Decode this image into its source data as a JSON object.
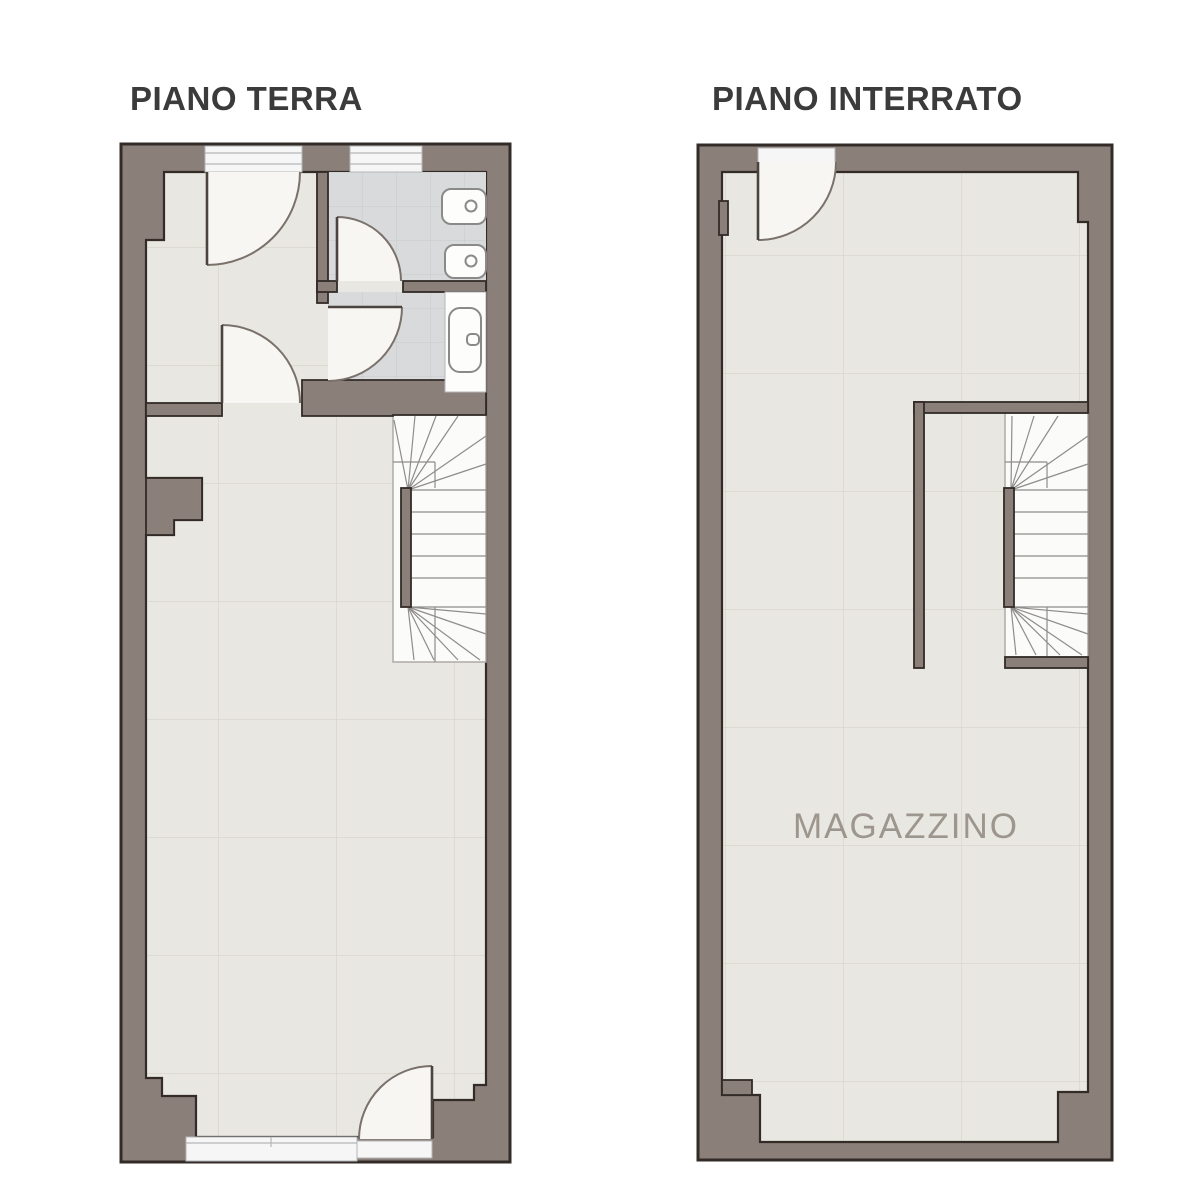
{
  "canvas": {
    "width": 1200,
    "height": 1200,
    "background": "#ffffff"
  },
  "plans": [
    {
      "key": "piano_terra",
      "title": "PIANO TERRA",
      "features": {
        "doors": [
          "front-entry-door",
          "vestibule-door",
          "wc-door",
          "bathroom-door",
          "rear-exit-door"
        ],
        "windows": [
          "front-door-glazing",
          "wc-window",
          "rear-shop-window"
        ],
        "fixtures": [
          "toilet",
          "bidet",
          "bathtub"
        ],
        "stairs": "winder-staircase"
      }
    },
    {
      "key": "piano_interrato",
      "title": "PIANO INTERRATO",
      "room_label": "MAGAZZINO",
      "features": {
        "doors": [
          "basement-entry-door"
        ],
        "stairs": "winder-staircase"
      }
    }
  ],
  "colors": {
    "wall": "#8b7f7a",
    "outline": "#322b27",
    "floor": "#e9e7e1",
    "floor-line": "#d9d5cc",
    "tile": "#d9dadc",
    "tile-line": "#c7c9cb",
    "stair": "#fbfbf9",
    "stair-line": "#8f8d89",
    "stair-border": "#aeaba6",
    "swing": "#f7f6f3",
    "swing-arc": "#7a716b",
    "leaf": "#4a433e",
    "fixture-stroke": "#8a8a88",
    "fixture-fill": "#fdfdfc",
    "window-fill": "#f6f6f6",
    "window-line": "#b4b7b8",
    "title": "#3b3b3b",
    "room-label": "#9c968e",
    "bg": "#ffffff"
  }
}
